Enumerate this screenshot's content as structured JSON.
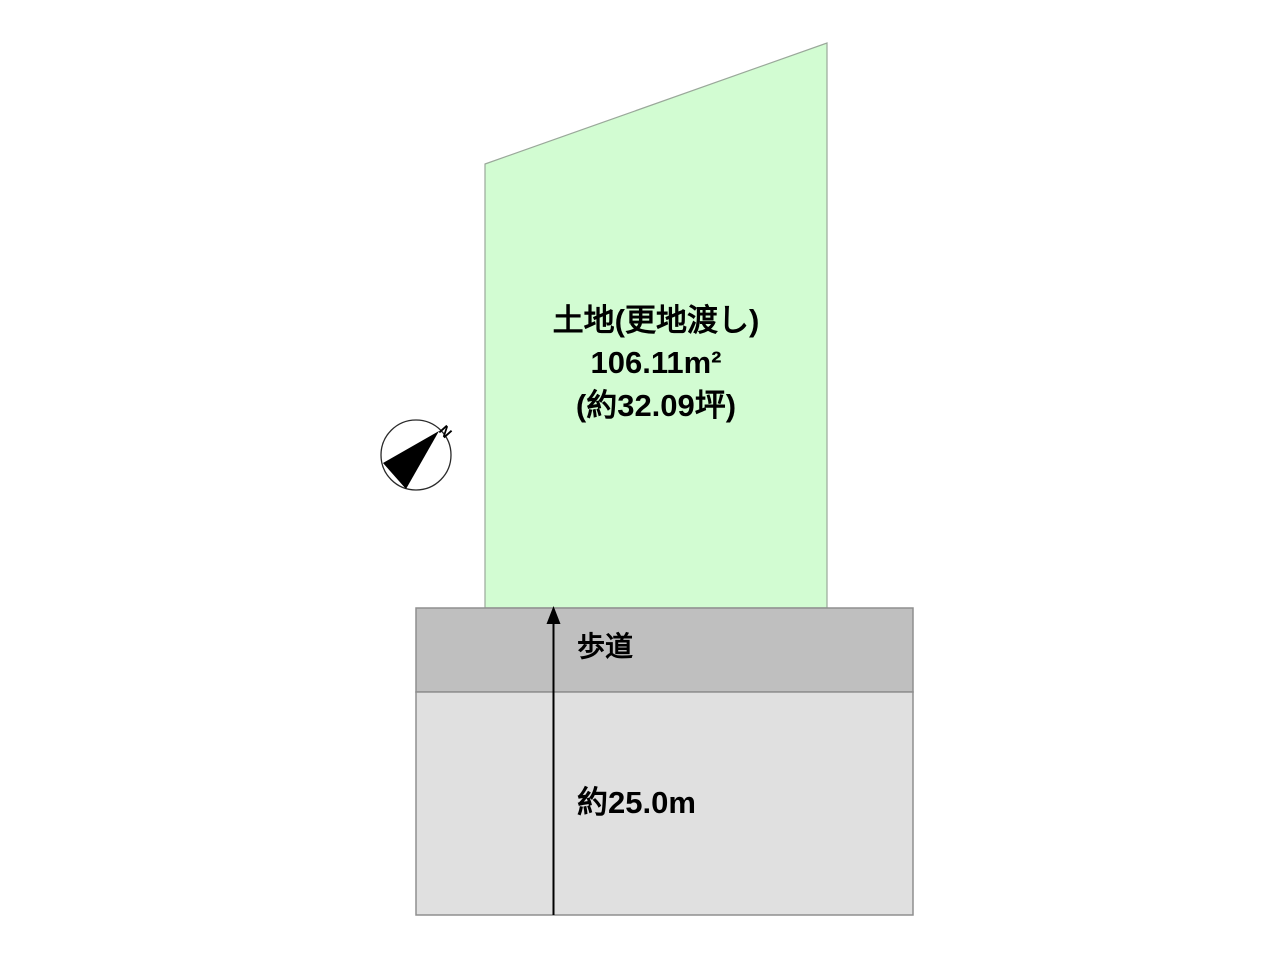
{
  "diagram": {
    "title": "land-plot-layout",
    "plot": {
      "label_line1": "土地(更地渡し)",
      "label_line2": "106.11m²",
      "label_line3": "(約32.09坪)",
      "fill": "#d2fcd2",
      "stroke": "#9aa89a"
    },
    "sidewalk": {
      "label": "歩道",
      "fill": "#bfbfbf",
      "stroke": "#8f8f8f"
    },
    "road": {
      "label": "約25.0m",
      "fill": "#e0e0e0",
      "stroke": "#8f8f8f"
    },
    "compass": {
      "north_label": "N",
      "needle_color": "#000000"
    }
  }
}
